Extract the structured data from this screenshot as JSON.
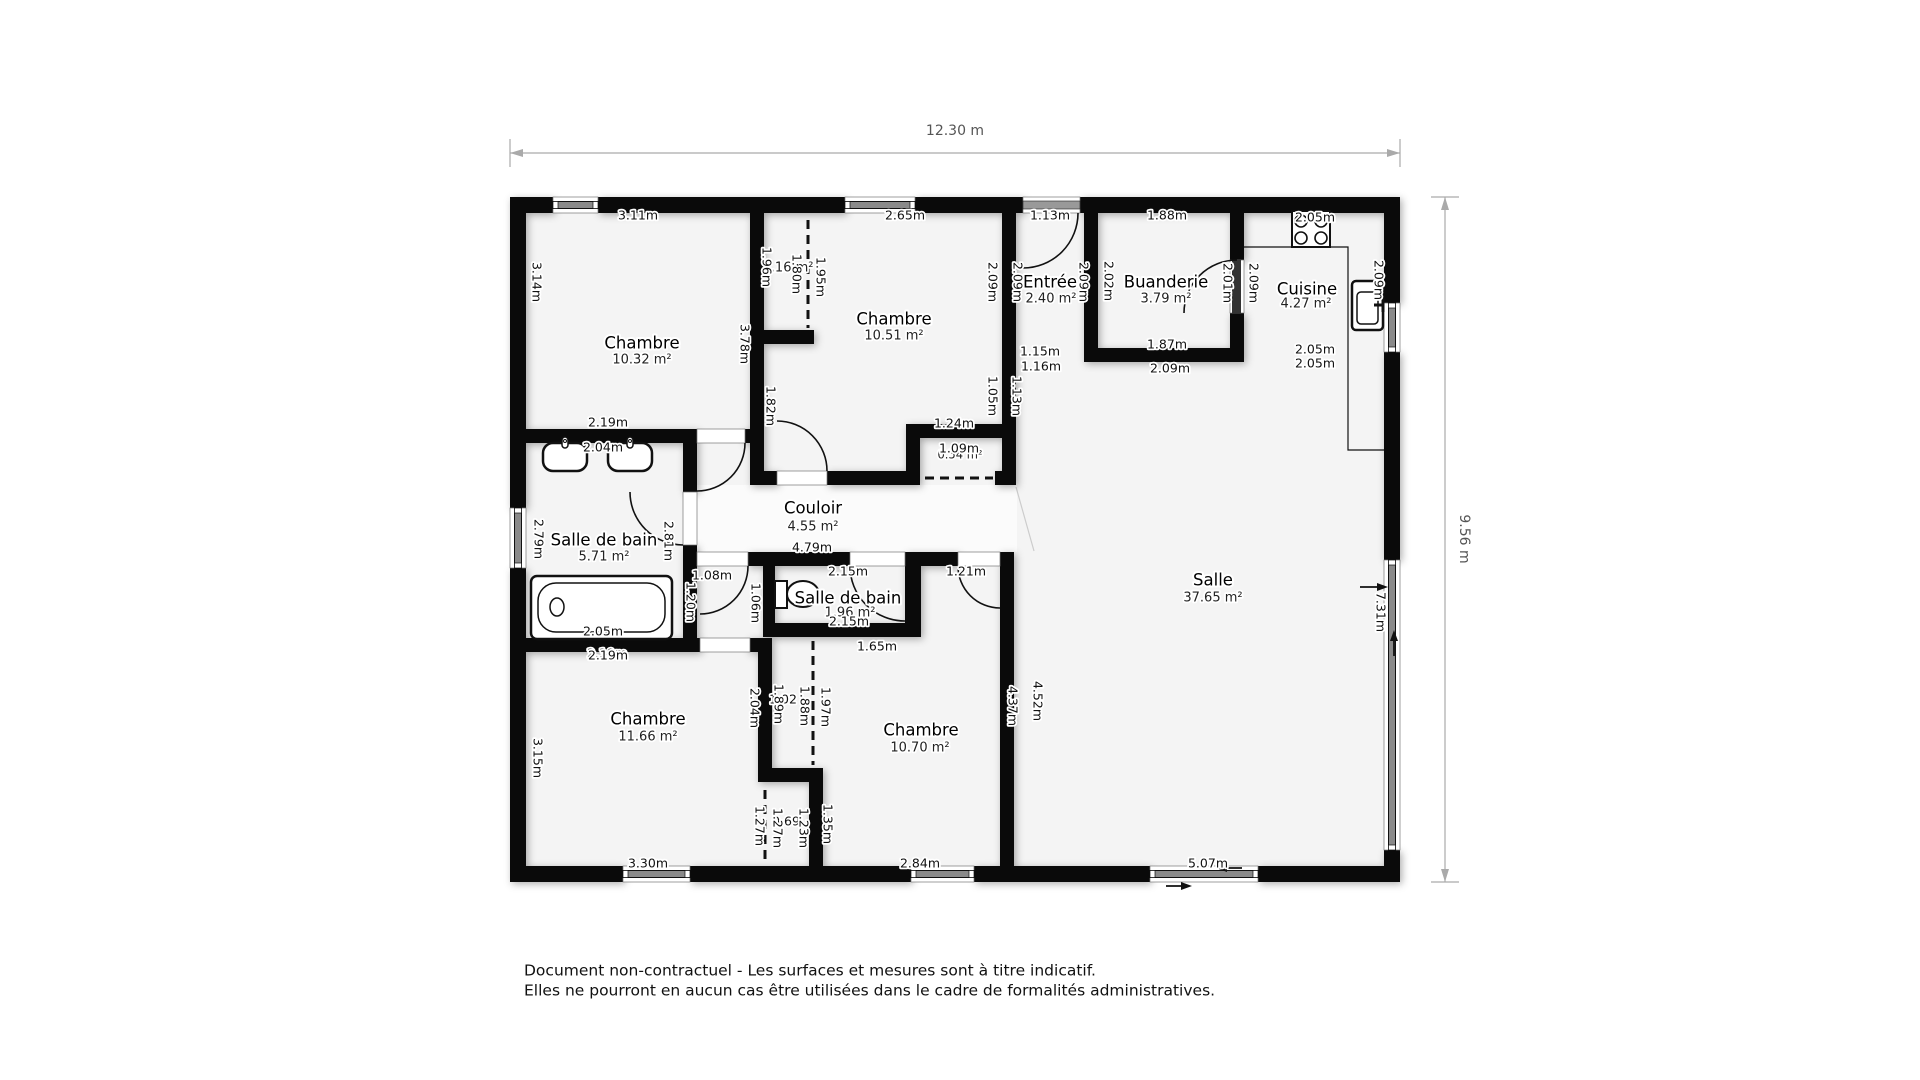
{
  "overall": {
    "width_label": "12.30 m",
    "height_label": "9.56 m"
  },
  "rooms": {
    "chambre_tl": {
      "name": "Chambre",
      "area": "10.32 m²"
    },
    "chambre_tm": {
      "name": "Chambre",
      "area": "10.51 m²"
    },
    "entree": {
      "name": "Entrée",
      "area": "2.40 m²"
    },
    "buanderie": {
      "name": "Buanderie",
      "area": "3.79 m²"
    },
    "cuisine": {
      "name": "Cuisine",
      "area": "4.27 m²"
    },
    "couloir": {
      "name": "Couloir",
      "area": "4.55 m²"
    },
    "sdb_grande": {
      "name": "Salle de bain",
      "area": "5.71 m²"
    },
    "sdb_petite": {
      "name": "Salle de bain",
      "area": "1.96 m²"
    },
    "salle": {
      "name": "Salle",
      "area": "37.65 m²"
    },
    "chambre_bl": {
      "name": "Chambre",
      "area": "11.66 m²"
    },
    "chambre_bm": {
      "name": "Chambre",
      "area": "10.70 m²"
    },
    "placard_haut": {
      "area": "1.16 m²"
    },
    "placard_couloir": {
      "area": "0.54 m²"
    }
  },
  "dims": {
    "c1_window": "3.11m",
    "c1_left": "3.14m",
    "placard_left": "1.96m",
    "placard_door": "1.80m",
    "placard_right": "1.95m",
    "c2_left": "3.78m",
    "c2_window": "2.65m",
    "c2_doorwall": "1.82m",
    "entree_window": "1.13m",
    "c2_right_out": "2.09m",
    "entree_left": "2.09m",
    "entree_right": "2.09m",
    "buanderie_left": "2.02m",
    "buanderie_window": "1.88m",
    "buanderie_door": "2.01m",
    "cuisine_left": "2.09m",
    "cuisine_top": "2.05m",
    "cuisine_right": "2.09m",
    "buanderie_bot1": "1.87m",
    "buanderie_bot2": "2.09m",
    "cuisine_bot1": "2.05m",
    "cuisine_bot2": "2.05m",
    "entree_bot1": "1.15m",
    "entree_bot2": "1.16m",
    "c2_right_low": "1.05m",
    "salle_left_top": "1.13m",
    "placard2_top": "1.24m",
    "placard2_width": "1.09m",
    "couloir_len": "4.79m",
    "sdb1_top": "2.19m",
    "sdb1_top2": "2.04m",
    "sdb1_left": "2.79m",
    "sdb1_right": "2.81m",
    "sdb1_tub": "2.05m",
    "sdb1_bot": "2.19m",
    "door_108": "1.08m",
    "door_215": "2.15m",
    "door_121": "1.21m",
    "wall_120": "1.20m",
    "wall_106": "1.06m",
    "sdb2_bot": "2.15m",
    "sdb2_below": "1.65m",
    "c3_left": "3.15m",
    "c3_top": "2.19m",
    "c3_bot": "3.30m",
    "wall_204": "2.04m",
    "clo_up_a": "1.02",
    "clo_up_b": "1.89m",
    "clo_up_c": "1.88m",
    "clo_up_d": "1.97m",
    "clo_lo_a": "1.27m",
    "clo_lo_b": "0.69",
    "clo_lo_c": "1.27m",
    "clo_lo_d": "1.23m",
    "clo_lo_e": "1.35m",
    "c4_right_in": "4.37m",
    "c4_right_out": "4.52m",
    "c4_bot": "2.84m",
    "salle_bot": "5.07m",
    "salle_right": "7.31m"
  },
  "footer": {
    "line1": "Document non-contractuel - Les surfaces et mesures sont à titre indicatif.",
    "line2": "Elles ne pourront en aucun cas être utilisées dans le cadre de formalités administratives."
  }
}
